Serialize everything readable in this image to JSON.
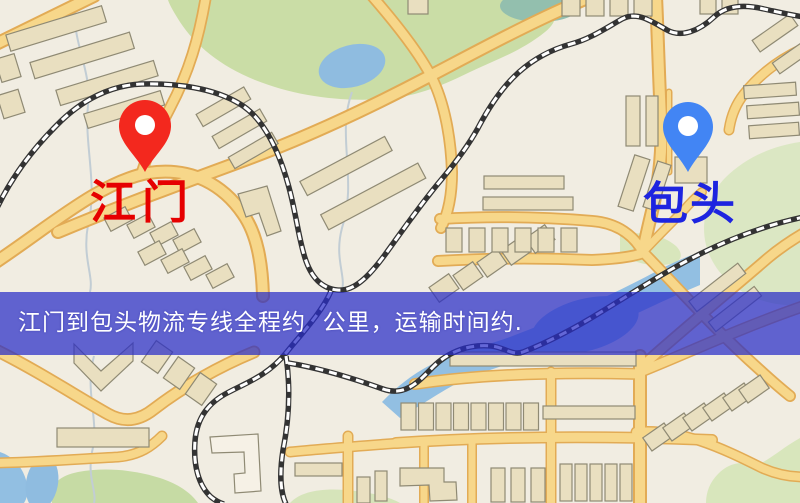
{
  "map": {
    "type": "stylized-street-map",
    "markers": [
      {
        "id": "origin",
        "label": "江门",
        "pin_color": "#f3281e",
        "label_color": "#e60000"
      },
      {
        "id": "destination",
        "label": "包头",
        "pin_color": "#4285f4",
        "label_color": "#1d24e0"
      }
    ],
    "palette": {
      "background": "#f1ede2",
      "park_green": "#cadda6",
      "light_green": "#dbe7c3",
      "water_blue": "#92bfe2",
      "road_fill": "#f7d78a",
      "road_casing": "#e2ab55",
      "building_fill": "#e9dfc0",
      "building_stroke": "#8f8a74",
      "railway_dark": "#333333"
    }
  },
  "banner": {
    "text": "江门到包头物流专线全程约  公里，运输时间约.",
    "background": "#2828c8",
    "opacity": 0.72,
    "text_color": "#ffffff"
  }
}
